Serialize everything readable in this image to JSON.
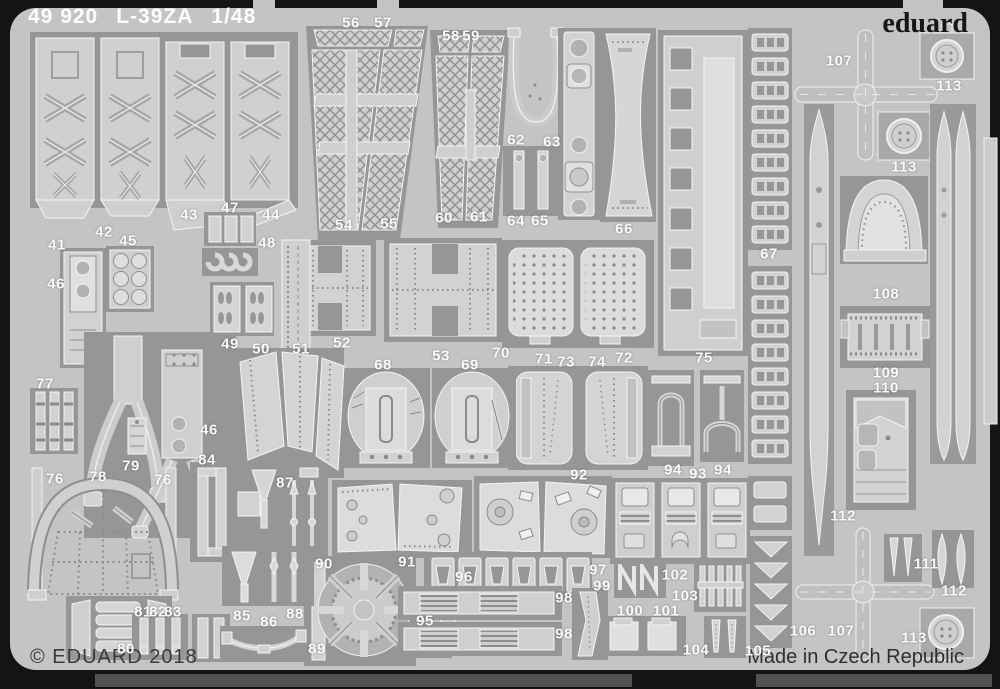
{
  "header": {
    "catalog": "49 920",
    "title": "L-39ZA",
    "scale": "1/48",
    "brand": "eduard"
  },
  "footer": {
    "copyright": "© EDUARD 2018",
    "origin": "Made in Czech Republic"
  },
  "colors": {
    "background": "#141414",
    "sheet": "#c4c4c4",
    "etched_patch": "#969696",
    "part": "#d2d2d2",
    "etch_line": "#f4f4f4",
    "label_text": "#fafafa"
  },
  "part_labels": [
    {
      "n": "41",
      "x": 57,
      "y": 245
    },
    {
      "n": "42",
      "x": 104,
      "y": 232
    },
    {
      "n": "43",
      "x": 189,
      "y": 215
    },
    {
      "n": "44",
      "x": 271,
      "y": 215
    },
    {
      "n": "45",
      "x": 128,
      "y": 241
    },
    {
      "n": "46",
      "x": 56,
      "y": 284
    },
    {
      "n": "46",
      "x": 209,
      "y": 430
    },
    {
      "n": "47",
      "x": 230,
      "y": 208
    },
    {
      "n": "48",
      "x": 267,
      "y": 243
    },
    {
      "n": "49",
      "x": 230,
      "y": 344
    },
    {
      "n": "50",
      "x": 261,
      "y": 349
    },
    {
      "n": "51",
      "x": 301,
      "y": 349
    },
    {
      "n": "52",
      "x": 342,
      "y": 343
    },
    {
      "n": "53",
      "x": 441,
      "y": 356
    },
    {
      "n": "54",
      "x": 344,
      "y": 225
    },
    {
      "n": "55",
      "x": 389,
      "y": 224
    },
    {
      "n": "56",
      "x": 351,
      "y": 23
    },
    {
      "n": "57",
      "x": 383,
      "y": 23
    },
    {
      "n": "58",
      "x": 451,
      "y": 36
    },
    {
      "n": "59",
      "x": 471,
      "y": 36
    },
    {
      "n": "60",
      "x": 444,
      "y": 218
    },
    {
      "n": "61",
      "x": 479,
      "y": 217
    },
    {
      "n": "62",
      "x": 516,
      "y": 140
    },
    {
      "n": "63",
      "x": 552,
      "y": 142
    },
    {
      "n": "64",
      "x": 516,
      "y": 221
    },
    {
      "n": "65",
      "x": 540,
      "y": 221
    },
    {
      "n": "66",
      "x": 624,
      "y": 229
    },
    {
      "n": "67",
      "x": 769,
      "y": 254
    },
    {
      "n": "68",
      "x": 383,
      "y": 365
    },
    {
      "n": "69",
      "x": 470,
      "y": 365
    },
    {
      "n": "70",
      "x": 501,
      "y": 353
    },
    {
      "n": "71",
      "x": 544,
      "y": 359
    },
    {
      "n": "72",
      "x": 624,
      "y": 358
    },
    {
      "n": "73",
      "x": 566,
      "y": 362
    },
    {
      "n": "74",
      "x": 597,
      "y": 362
    },
    {
      "n": "75",
      "x": 704,
      "y": 358
    },
    {
      "n": "76",
      "x": 55,
      "y": 479
    },
    {
      "n": "76",
      "x": 163,
      "y": 480
    },
    {
      "n": "77",
      "x": 45,
      "y": 384
    },
    {
      "n": "78",
      "x": 98,
      "y": 477
    },
    {
      "n": "79",
      "x": 131,
      "y": 466
    },
    {
      "n": "80",
      "x": 126,
      "y": 649
    },
    {
      "n": "81",
      "x": 143,
      "y": 612
    },
    {
      "n": "82",
      "x": 158,
      "y": 612
    },
    {
      "n": "83",
      "x": 173,
      "y": 612
    },
    {
      "n": "84",
      "x": 207,
      "y": 460
    },
    {
      "n": "85",
      "x": 242,
      "y": 616
    },
    {
      "n": "86",
      "x": 269,
      "y": 622
    },
    {
      "n": "87",
      "x": 285,
      "y": 483
    },
    {
      "n": "88",
      "x": 295,
      "y": 614
    },
    {
      "n": "89",
      "x": 317,
      "y": 649
    },
    {
      "n": "90",
      "x": 324,
      "y": 564
    },
    {
      "n": "91",
      "x": 407,
      "y": 562
    },
    {
      "n": "92",
      "x": 579,
      "y": 475
    },
    {
      "n": "93",
      "x": 698,
      "y": 474
    },
    {
      "n": "94",
      "x": 673,
      "y": 470
    },
    {
      "n": "94",
      "x": 723,
      "y": 470
    },
    {
      "n": "95",
      "x": 425,
      "y": 621
    },
    {
      "n": "96",
      "x": 464,
      "y": 577
    },
    {
      "n": "97",
      "x": 598,
      "y": 570
    },
    {
      "n": "98",
      "x": 564,
      "y": 598
    },
    {
      "n": "98",
      "x": 564,
      "y": 634
    },
    {
      "n": "99",
      "x": 602,
      "y": 586
    },
    {
      "n": "100",
      "x": 630,
      "y": 611
    },
    {
      "n": "101",
      "x": 666,
      "y": 611
    },
    {
      "n": "102",
      "x": 675,
      "y": 575
    },
    {
      "n": "103",
      "x": 685,
      "y": 596
    },
    {
      "n": "104",
      "x": 696,
      "y": 650
    },
    {
      "n": "105",
      "x": 758,
      "y": 651
    },
    {
      "n": "106",
      "x": 803,
      "y": 631
    },
    {
      "n": "107",
      "x": 839,
      "y": 61
    },
    {
      "n": "107",
      "x": 841,
      "y": 631
    },
    {
      "n": "108",
      "x": 886,
      "y": 294
    },
    {
      "n": "109",
      "x": 886,
      "y": 373
    },
    {
      "n": "110",
      "x": 886,
      "y": 388
    },
    {
      "n": "111",
      "x": 926,
      "y": 564
    },
    {
      "n": "112",
      "x": 843,
      "y": 516
    },
    {
      "n": "112",
      "x": 954,
      "y": 591
    },
    {
      "n": "113",
      "x": 949,
      "y": 86
    },
    {
      "n": "113",
      "x": 904,
      "y": 167
    },
    {
      "n": "113",
      "x": 914,
      "y": 638
    }
  ]
}
